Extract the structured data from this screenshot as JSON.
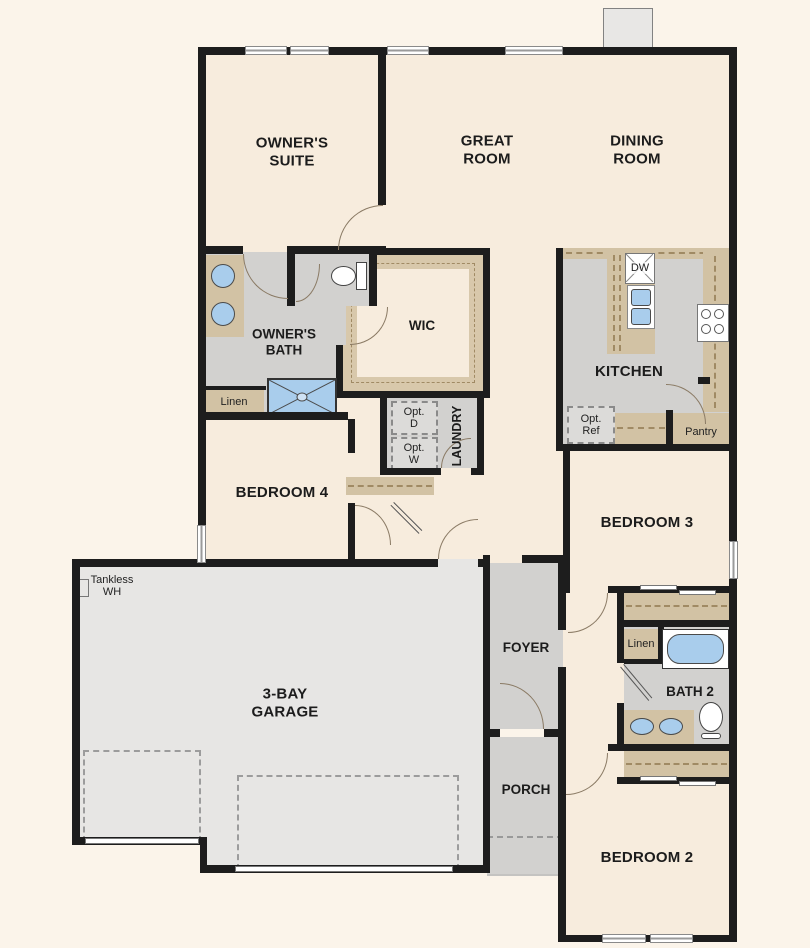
{
  "rooms": {
    "owners_suite": "OWNER'S\nSUITE",
    "great_room": "GREAT\nROOM",
    "dining_room": "DINING\nROOM",
    "kitchen": "KITCHEN",
    "owners_bath": "OWNER'S\nBATH",
    "wic": "WIC",
    "laundry": "LAUNDRY",
    "bedroom4": "BEDROOM 4",
    "bedroom3": "BEDROOM 3",
    "bedroom2": "BEDROOM 2",
    "bath2": "BATH 2",
    "foyer": "FOYER",
    "porch": "PORCH",
    "garage": "3-BAY\nGARAGE"
  },
  "annotations": {
    "linen_owners": "Linen",
    "linen_bath2": "Linen",
    "pantry": "Pantry",
    "dishwasher": "DW",
    "opt_dryer": "Opt.\nD",
    "opt_washer": "Opt.\nW",
    "opt_ref": "Opt.\nRef",
    "tankless_wh": "Tankless\nWH"
  },
  "colors": {
    "wall": "#1d1d1d",
    "room_floor": "#f7ecdd",
    "wet_area_floor": "#d2d1cf",
    "garage_floor": "#e7e6e4",
    "counter_tan": "#d2c2a4",
    "fixture_blue": "#a9cdec",
    "background": "#fbf4ea"
  }
}
